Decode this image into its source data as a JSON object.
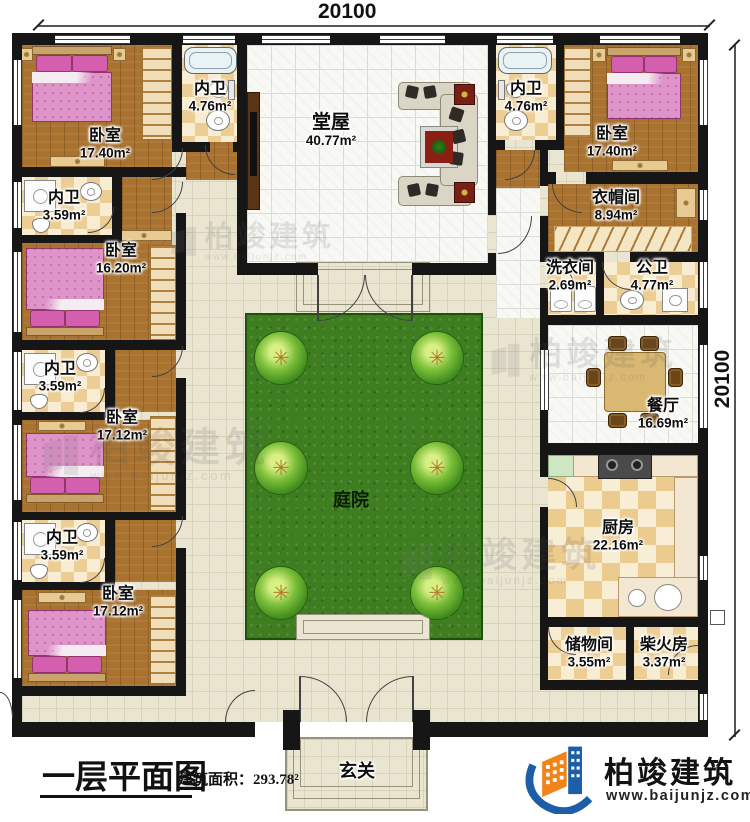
{
  "dimensions": {
    "top": "20100",
    "right": "20100"
  },
  "title": {
    "main": "一层平面图",
    "area_prefix": "建筑面积：",
    "area_value": "293.78²"
  },
  "rooms": {
    "bedroom_tl": {
      "name": "卧室",
      "area": "17.40m²"
    },
    "bath_tl": {
      "name": "内卫",
      "area": "4.76m²"
    },
    "bath_l2": {
      "name": "内卫",
      "area": "3.59m²"
    },
    "bedroom_l2": {
      "name": "卧室",
      "area": "16.20m²"
    },
    "bath_l3": {
      "name": "内卫",
      "area": "3.59m²"
    },
    "bedroom_l3": {
      "name": "卧室",
      "area": "17.12m²"
    },
    "bath_l4": {
      "name": "内卫",
      "area": "3.59m²"
    },
    "bedroom_l4": {
      "name": "卧室",
      "area": "17.12m²"
    },
    "hall": {
      "name": "堂屋",
      "area": "40.77m²"
    },
    "bath_tr": {
      "name": "内卫",
      "area": "4.76m²"
    },
    "bedroom_tr": {
      "name": "卧室",
      "area": "17.40m²"
    },
    "cloakroom": {
      "name": "衣帽间",
      "area": "8.94m²"
    },
    "laundry": {
      "name": "洗衣间",
      "area": "2.69m²"
    },
    "public_bath": {
      "name": "公卫",
      "area": "4.77m²"
    },
    "dining": {
      "name": "餐厅",
      "area": "16.69m²"
    },
    "kitchen": {
      "name": "厨房",
      "area": "22.16m²"
    },
    "storage": {
      "name": "储物间",
      "area": "3.55m²"
    },
    "firewood": {
      "name": "柴火房",
      "area": "3.37m²"
    },
    "courtyard": {
      "name": "庭院"
    },
    "foyer": {
      "name": "玄关"
    }
  },
  "branding": {
    "company": "柏竣建筑",
    "website": "www.baijunjz.com"
  },
  "watermark": {
    "text": "柏竣建筑",
    "sub": "www.baijunjz.com"
  },
  "colors": {
    "wall": "#161616",
    "lawn": "#3e7e20",
    "wood": "#a9722f",
    "logo_blue": "#1c5fa8",
    "logo_orange": "#f08419"
  }
}
